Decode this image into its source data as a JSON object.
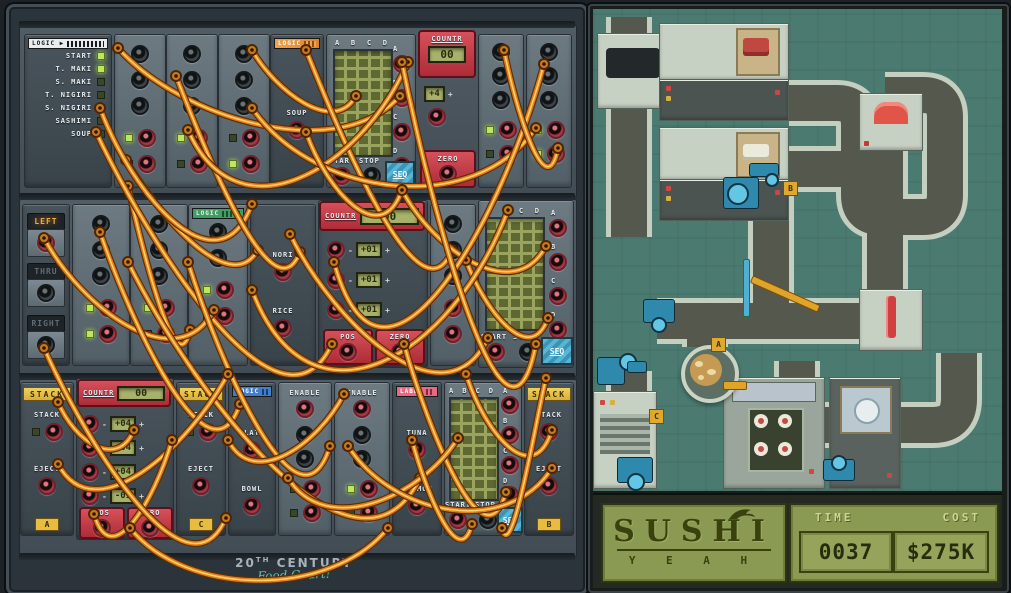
{
  "left": {
    "strips": {
      "white": "LOGIC ▶",
      "orange": "LOGIC",
      "green": "LOGIC",
      "blue": "LOGIC",
      "pink": "LABEL"
    },
    "logic_items": [
      "START",
      "T. MAKI",
      "S. MAKI",
      "T. NIGIRI",
      "S. NIGIRI",
      "SASHIMI",
      "SOUP"
    ],
    "soup_label": "SOUP",
    "seq": {
      "cols": [
        "A",
        "B",
        "C",
        "D"
      ],
      "outs": [
        "A",
        "B",
        "C",
        "D"
      ],
      "start": "START",
      "stop": "STOP",
      "logo": "SEQ"
    },
    "counter_top": {
      "title": "COUNTR",
      "value": "00",
      "step": "+4",
      "minus": "-",
      "plus": "+",
      "zero": "ZERO"
    },
    "dir_items": [
      "LEFT",
      "THRU",
      "RIGHT"
    ],
    "nori": "NORI",
    "rice": "RICE",
    "counter_mid": {
      "title": "COUNTR",
      "value": "00",
      "rows": [
        "+01",
        "+01",
        "+01"
      ],
      "minus": "-",
      "plus": "+",
      "pos": "POS",
      "zero": "ZERO"
    },
    "counter_bot": {
      "title": "COUNTR",
      "value": "00",
      "rows": [
        "+04",
        "+04",
        "+04",
        "-01"
      ],
      "minus": "-",
      "plus": "+",
      "pos": "POS",
      "zero": "ZERO"
    },
    "stack": {
      "header": "STACK",
      "stack": "STACK",
      "eject": "EJECT"
    },
    "badges": {
      "a": "A",
      "b": "B",
      "c": "C"
    },
    "plate": "PLATE",
    "bowl": "BOWL",
    "enable": "ENABLE",
    "tuna": "TUNA",
    "salmon": "SALMON",
    "footer": {
      "num": "20",
      "sup": "TH",
      "rest": " CENTURY",
      "script": "Food Court!"
    }
  },
  "right": {
    "badges": {
      "a": "A",
      "b": "B",
      "c": "C"
    },
    "status": {
      "title": "SUSHI",
      "yeah": "Y E A H",
      "time_label": "TIME",
      "time_value": "0037",
      "cost_label": "COST",
      "cost_value": "$275K"
    }
  },
  "cables": [
    [
      118,
      48,
      400,
      96,
      70
    ],
    [
      126,
      160,
      258,
      250,
      50
    ],
    [
      100,
      108,
      252,
      204,
      90
    ],
    [
      176,
      76,
      300,
      252,
      70
    ],
    [
      252,
      50,
      356,
      96,
      40
    ],
    [
      306,
      50,
      452,
      250,
      80
    ],
    [
      128,
      186,
      190,
      330,
      60
    ],
    [
      96,
      132,
      332,
      344,
      110
    ],
    [
      188,
      130,
      408,
      62,
      110
    ],
    [
      252,
      108,
      536,
      128,
      90
    ],
    [
      306,
      132,
      402,
      190,
      60
    ],
    [
      402,
      190,
      546,
      246,
      60
    ],
    [
      466,
      260,
      548,
      318,
      50
    ],
    [
      44,
      238,
      214,
      310,
      70
    ],
    [
      100,
      232,
      240,
      404,
      90
    ],
    [
      128,
      262,
      420,
      478,
      130
    ],
    [
      188,
      262,
      330,
      446,
      100
    ],
    [
      252,
      290,
      508,
      210,
      150
    ],
    [
      290,
      234,
      488,
      338,
      90
    ],
    [
      334,
      262,
      544,
      64,
      170
    ],
    [
      404,
      344,
      506,
      492,
      80
    ],
    [
      466,
      374,
      552,
      430,
      60
    ],
    [
      58,
      402,
      134,
      430,
      40
    ],
    [
      58,
      464,
      228,
      374,
      70
    ],
    [
      94,
      514,
      172,
      440,
      60
    ],
    [
      130,
      528,
      388,
      528,
      70
    ],
    [
      228,
      440,
      344,
      394,
      50
    ],
    [
      288,
      478,
      458,
      438,
      60
    ],
    [
      348,
      446,
      552,
      468,
      70
    ],
    [
      412,
      440,
      472,
      524,
      50
    ],
    [
      44,
      348,
      226,
      518,
      90
    ],
    [
      504,
      50,
      558,
      148,
      60
    ],
    [
      546,
      378,
      502,
      528,
      40
    ],
    [
      402,
      62,
      536,
      344,
      150
    ]
  ]
}
